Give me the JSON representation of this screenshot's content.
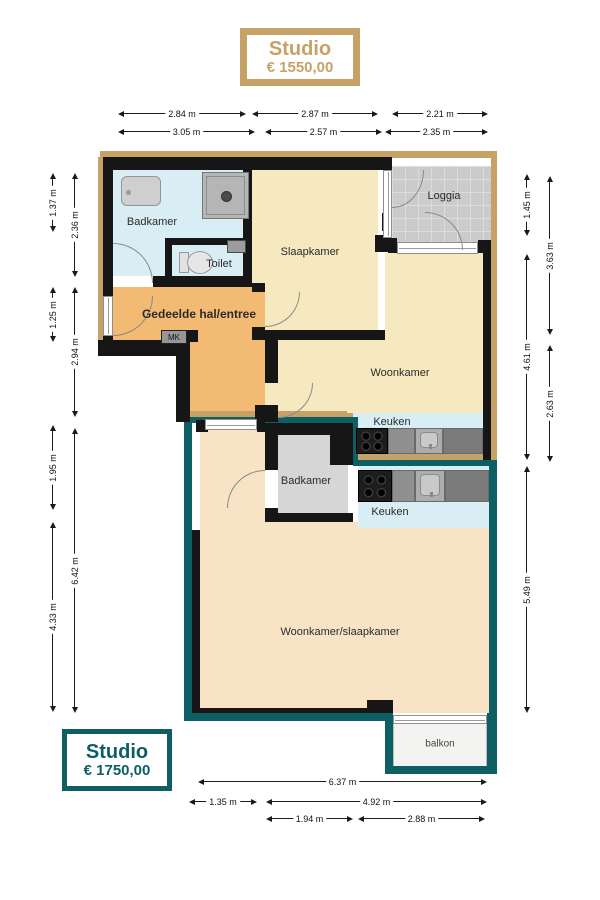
{
  "badges": {
    "top": {
      "title": "Studio",
      "price": "€ 1550,00"
    },
    "bottom": {
      "title": "Studio",
      "price": "€ 1750,00"
    }
  },
  "colors": {
    "studio_1550_accent": "#c7a266",
    "studio_1750_accent": "#0d5f63",
    "wet_room_floor": "#d9edf5",
    "living_floor": "#f6e9c0",
    "hall_floor": "#f2ba72",
    "studio2_floor": "#f9e3c5"
  },
  "rooms": {
    "badkamer_top": "Badkamer",
    "toilet": "Toilet",
    "slaapkamer": "Slaapkamer",
    "loggia": "Loggia",
    "hal": "Gedeelde hal/entree",
    "mk": "MK",
    "woonkamer": "Woonkamer",
    "keuken_top": "Keuken",
    "badkamer_bottom": "Badkamer",
    "keuken_bottom": "Keuken",
    "woonslaap": "Woonkamer/slaapkamer",
    "balkon": "balkon"
  },
  "dimensions": {
    "top_row1": [
      "2.84 m",
      "2.87 m",
      "2.21 m"
    ],
    "top_row2": [
      "3.05 m",
      "2.57 m",
      "2.35 m"
    ],
    "left_outer": [
      "1.37 m",
      "1.25 m",
      "1.95 m",
      "4.33 m"
    ],
    "left_inner": [
      "2.36 m",
      "2.94 m",
      "6.42 m"
    ],
    "right_inner": [
      "1.45 m",
      "4.61 m",
      "5.49 m"
    ],
    "right_outer": [
      "3.63 m",
      "2.63 m"
    ],
    "bottom_row1": [
      "6.37 m"
    ],
    "bottom_row2": [
      "1.35 m",
      "4.92 m"
    ],
    "bottom_row3": [
      "1.94 m",
      "2.88 m"
    ]
  }
}
